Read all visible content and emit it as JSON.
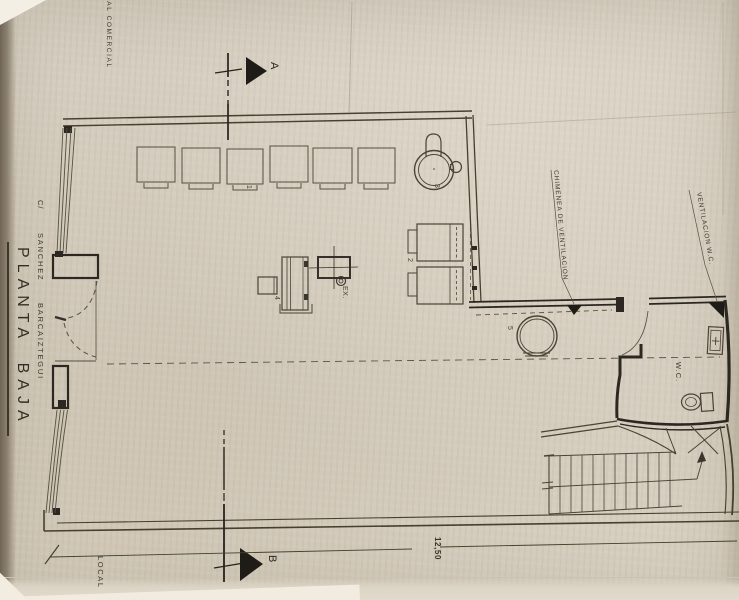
{
  "plan": {
    "title": "PLANTA BAJA",
    "street": {
      "prefix": "C/",
      "line1": "SANCHEZ",
      "line2": "BARCAIZTEGUI"
    },
    "zone_top": "CAL COMERCIAL",
    "zone_bottom": "LOCAL",
    "labels": {
      "chimney": "CHIMENEA DE VENTILACION",
      "vent_wc": "VENTILACION W.C.",
      "wc": "W.C.",
      "extractor": "EX.",
      "dimension": "12,50"
    },
    "sections": {
      "a": "A",
      "b": "B"
    },
    "items": {
      "n1": "1",
      "n2": "2",
      "n3": "3",
      "n4": "4",
      "n5": "5"
    },
    "colors": {
      "paper": "#d6cec0",
      "ink": "#4a4334",
      "ink_heavy": "#292420"
    }
  }
}
